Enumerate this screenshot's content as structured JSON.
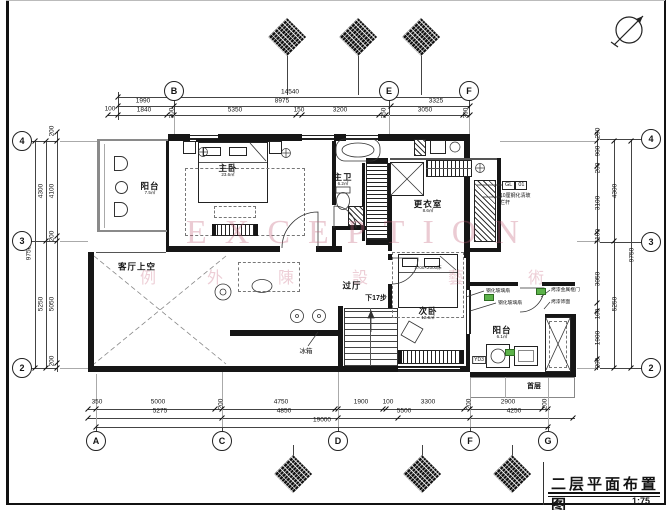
{
  "title_block": {
    "title": "二层平面布置图",
    "scale": "1:75"
  },
  "watermark": {
    "latin": "EXCEPTION",
    "latin_x": 186,
    "latin_y": 214,
    "cjk": [
      "例",
      "外",
      "陳",
      "設",
      "藝",
      "術"
    ],
    "cjk_x": [
      140,
      207,
      278,
      352,
      448,
      528
    ],
    "cjk_y": 264,
    "color": "#c4607a"
  },
  "axes": [
    {
      "l": "B",
      "x": 174,
      "y": 91
    },
    {
      "l": "E",
      "x": 389,
      "y": 91
    },
    {
      "l": "F",
      "x": 469,
      "y": 91
    },
    {
      "l": "A",
      "x": 96,
      "y": 441
    },
    {
      "l": "C",
      "x": 222,
      "y": 441
    },
    {
      "l": "D",
      "x": 338,
      "y": 441
    },
    {
      "l": "F",
      "x": 470,
      "y": 441
    },
    {
      "l": "G",
      "x": 548,
      "y": 441
    },
    {
      "l": "4",
      "x": 22,
      "y": 141
    },
    {
      "l": "3",
      "x": 22,
      "y": 241
    },
    {
      "l": "2",
      "x": 22,
      "y": 368
    },
    {
      "l": "4",
      "x": 651,
      "y": 139
    },
    {
      "l": "3",
      "x": 651,
      "y": 242
    },
    {
      "l": "2",
      "x": 651,
      "y": 368
    }
  ],
  "dims": [
    [
      "14540",
      290,
      92,
      0
    ],
    [
      "1990",
      143,
      101,
      0
    ],
    [
      "8975",
      282,
      101,
      0
    ],
    [
      "3325",
      436,
      101,
      0
    ],
    [
      "100",
      110,
      109,
      0
    ],
    [
      "1840",
      144,
      110,
      0
    ],
    [
      "300",
      172,
      113,
      1
    ],
    [
      "5350",
      235,
      110,
      0
    ],
    [
      "150",
      299,
      110,
      0
    ],
    [
      "3200",
      340,
      110,
      0
    ],
    [
      "250",
      384,
      113,
      1
    ],
    [
      "3050",
      425,
      110,
      0
    ],
    [
      "300",
      466,
      113,
      1
    ],
    [
      "9750",
      29,
      253,
      1
    ],
    [
      "4300",
      41,
      191,
      1
    ],
    [
      "5250",
      41,
      304,
      1
    ],
    [
      "4100",
      52,
      191,
      1
    ],
    [
      "5050",
      52,
      304,
      1
    ],
    [
      "200",
      52,
      131,
      1
    ],
    [
      "200",
      52,
      236,
      1
    ],
    [
      "200",
      52,
      361,
      1
    ],
    [
      "200",
      598,
      133,
      1
    ],
    [
      "900",
      598,
      151,
      1
    ],
    [
      "200",
      598,
      168,
      1
    ],
    [
      "3100",
      598,
      203,
      1
    ],
    [
      "1100",
      598,
      236,
      1
    ],
    [
      "3050",
      598,
      279,
      1
    ],
    [
      "100",
      598,
      314,
      1
    ],
    [
      "1900",
      598,
      338,
      1
    ],
    [
      "200",
      598,
      363,
      1
    ],
    [
      "4300",
      615,
      191,
      1
    ],
    [
      "5250",
      615,
      304,
      1
    ],
    [
      "9750",
      632,
      255,
      1
    ],
    [
      "350",
      97,
      402,
      0
    ],
    [
      "5000",
      158,
      402,
      0
    ],
    [
      "200",
      221,
      404,
      1
    ],
    [
      "4750",
      281,
      402,
      0
    ],
    [
      "1900",
      361,
      402,
      0
    ],
    [
      "100",
      388,
      402,
      0
    ],
    [
      "3300",
      428,
      402,
      0
    ],
    [
      "200",
      469,
      404,
      1
    ],
    [
      "2900",
      508,
      402,
      0
    ],
    [
      "200",
      545,
      404,
      1
    ],
    [
      "5275",
      160,
      411,
      0
    ],
    [
      "4850",
      284,
      411,
      0
    ],
    [
      "5500",
      404,
      411,
      0
    ],
    [
      "4250",
      514,
      411,
      0
    ],
    [
      "19000",
      322,
      420,
      0
    ]
  ],
  "ticks": [
    [
      108,
      115
    ],
    [
      118,
      115
    ],
    [
      167,
      115
    ],
    [
      174,
      115
    ],
    [
      296,
      115
    ],
    [
      302,
      115
    ],
    [
      379,
      115
    ],
    [
      386,
      115
    ],
    [
      463,
      115
    ],
    [
      470,
      115
    ],
    [
      118,
      106
    ],
    [
      174,
      106
    ],
    [
      391,
      106
    ],
    [
      470,
      106
    ],
    [
      118,
      97
    ],
    [
      470,
      97
    ],
    [
      88,
      409
    ],
    [
      96,
      409
    ],
    [
      215,
      409
    ],
    [
      222,
      409
    ],
    [
      335,
      409
    ],
    [
      338,
      409
    ],
    [
      383,
      409
    ],
    [
      386,
      409
    ],
    [
      464,
      409
    ],
    [
      470,
      409
    ],
    [
      542,
      409
    ],
    [
      548,
      409
    ],
    [
      88,
      418
    ],
    [
      222,
      418
    ],
    [
      338,
      418
    ],
    [
      398,
      418
    ],
    [
      470,
      418
    ],
    [
      573,
      418
    ],
    [
      96,
      427
    ],
    [
      548,
      427
    ],
    [
      57,
      132
    ],
    [
      57,
      141
    ],
    [
      57,
      236
    ],
    [
      57,
      241
    ],
    [
      57,
      363
    ],
    [
      57,
      368
    ],
    [
      46,
      141
    ],
    [
      46,
      241
    ],
    [
      46,
      368
    ],
    [
      35,
      141
    ],
    [
      35,
      368
    ],
    [
      597,
      132
    ],
    [
      597,
      141
    ],
    [
      597,
      166
    ],
    [
      597,
      232
    ],
    [
      597,
      241
    ],
    [
      597,
      303
    ],
    [
      597,
      311
    ],
    [
      597,
      359
    ],
    [
      597,
      368
    ],
    [
      614,
      141
    ],
    [
      614,
      241
    ],
    [
      614,
      368
    ],
    [
      631,
      141
    ],
    [
      631,
      368
    ]
  ],
  "lines": [
    [
      118,
      97,
      352,
      1,
      0
    ],
    [
      118,
      106,
      352,
      1,
      0
    ],
    [
      108,
      115,
      362,
      1,
      0
    ],
    [
      88,
      409,
      462,
      1,
      0
    ],
    [
      88,
      418,
      487,
      1,
      0
    ],
    [
      96,
      427,
      454,
      1,
      0
    ],
    [
      35,
      141,
      1,
      227,
      0
    ],
    [
      46,
      141,
      1,
      227,
      0
    ],
    [
      57,
      132,
      1,
      240,
      0
    ],
    [
      597,
      132,
      1,
      238,
      0
    ],
    [
      614,
      141,
      1,
      227,
      0
    ],
    [
      631,
      141,
      1,
      227,
      0
    ],
    [
      118,
      92,
      1,
      28,
      0
    ],
    [
      174,
      99,
      1,
      16,
      0
    ],
    [
      389,
      99,
      1,
      16,
      0
    ],
    [
      469,
      99,
      1,
      16,
      0
    ],
    [
      96,
      427,
      1,
      7,
      0
    ],
    [
      222,
      427,
      1,
      7,
      0
    ],
    [
      338,
      427,
      1,
      7,
      0
    ],
    [
      470,
      427,
      1,
      7,
      0
    ],
    [
      548,
      427,
      1,
      7,
      0
    ],
    [
      31,
      141,
      26,
      1,
      0
    ],
    [
      31,
      241,
      26,
      1,
      0
    ],
    [
      31,
      368,
      26,
      1,
      0
    ],
    [
      600,
      139,
      43,
      1,
      0
    ],
    [
      600,
      242,
      43,
      1,
      0
    ],
    [
      600,
      368,
      43,
      1,
      0
    ],
    [
      287,
      53,
      1,
      42,
      0
    ],
    [
      358,
      53,
      1,
      42,
      0
    ],
    [
      421,
      53,
      1,
      42,
      0
    ],
    [
      293,
      445,
      1,
      13,
      0
    ],
    [
      422,
      445,
      1,
      13,
      0
    ],
    [
      512,
      445,
      1,
      13,
      0
    ],
    [
      60,
      141,
      37,
      1,
      1
    ],
    [
      500,
      141,
      97,
      1,
      1
    ],
    [
      60,
      241,
      28,
      1,
      1
    ],
    [
      577,
      241,
      20,
      1,
      1
    ],
    [
      60,
      368,
      28,
      1,
      1
    ],
    [
      577,
      368,
      20,
      1,
      1
    ],
    [
      96,
      374,
      1,
      53,
      1
    ],
    [
      222,
      372,
      1,
      55,
      1
    ],
    [
      338,
      372,
      1,
      55,
      1
    ],
    [
      470,
      378,
      1,
      49,
      1
    ],
    [
      548,
      378,
      1,
      49,
      1
    ],
    [
      174,
      115,
      1,
      19,
      1
    ],
    [
      389,
      115,
      1,
      19,
      1
    ],
    [
      469,
      115,
      1,
      19,
      1
    ]
  ],
  "rooms": [
    {
      "name": "阳台",
      "area": "7.5㎡",
      "x": 150,
      "y": 189
    },
    {
      "name": "主卧",
      "area": "23.6㎡",
      "x": 228,
      "y": 171
    },
    {
      "name": "主卫",
      "area": "6.2㎡",
      "x": 343,
      "y": 180
    },
    {
      "name": "更衣室",
      "area": "8.6㎡",
      "x": 428,
      "y": 207
    },
    {
      "name": "客厅上空",
      "x": 137,
      "y": 267
    },
    {
      "name": "过厅",
      "x": 352,
      "y": 286
    },
    {
      "name": "次卧",
      "area": "12.6㎡",
      "x": 428,
      "y": 314
    },
    {
      "name": "阳台",
      "area": "6.1㎡",
      "x": 502,
      "y": 333
    }
  ],
  "annotations": [
    {
      "t": "下17步",
      "x": 376,
      "y": 298,
      "s": 7,
      "b": 1
    },
    {
      "t": "冰箱",
      "x": 306,
      "y": 350,
      "s": 6.5,
      "b": 0
    },
    {
      "t": "1700×2000床",
      "x": 428,
      "y": 268,
      "s": 4.5,
      "b": 0
    },
    {
      "t": "YD3",
      "x": 479,
      "y": 360,
      "s": 5,
      "b": 0,
      "box": 1
    },
    {
      "t": "首层",
      "x": 534,
      "y": 386,
      "s": 7,
      "b": 1
    }
  ],
  "callouts": {
    "glass_rail": {
      "code": "GL",
      "num": "01",
      "desc1": "10厘钢化清玻",
      "desc2": "栏杆"
    },
    "left_top": "钢化玻璃扇",
    "left_bottom": "钢化玻璃扇",
    "right_top": "烤漆金属框门",
    "right_bottom": "烤漆饰面"
  },
  "markers": {
    "top_y": 37,
    "bottom_y": 474,
    "top_x": [
      287,
      358,
      421
    ],
    "bottom_x": [
      293,
      422,
      512
    ]
  },
  "badges": [
    [
      484,
      294
    ],
    [
      536,
      288
    ],
    [
      505,
      349
    ]
  ],
  "north_arrow": "north-compass"
}
